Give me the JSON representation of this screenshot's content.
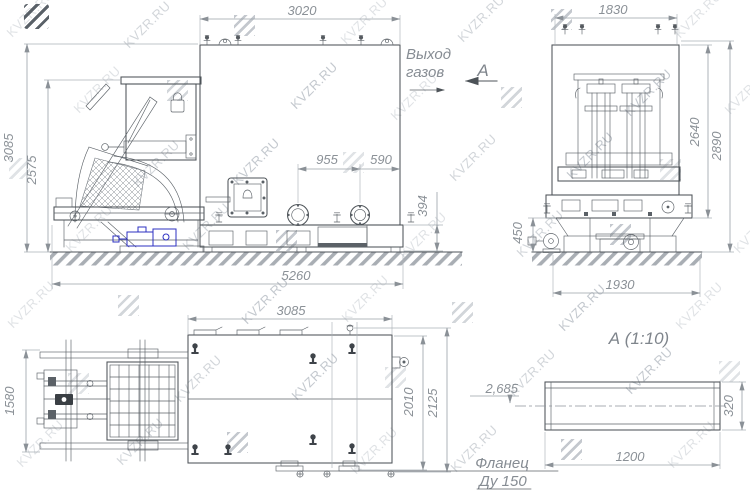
{
  "branding": {
    "watermark_text": "KVZR.RU"
  },
  "front_view": {
    "gas_outlet_line1": "Выход",
    "gas_outlet_line2": "газов",
    "view_arrow_label": "А",
    "dim_width_top": "3020",
    "dim_height_overall": "3085",
    "dim_height_hopper": "2575",
    "dim_flange_spacing": "955",
    "dim_flange_to_edge": "590",
    "dim_base_height": "394",
    "dim_length_overall": "5260"
  },
  "side_view": {
    "dim_width_top": "1830",
    "dim_height_body": "2640",
    "dim_height_overall": "2890",
    "dim_base_height": "450",
    "dim_width_base": "1930"
  },
  "plan_view": {
    "dim_length": "3085",
    "dim_tipper_width": "1580",
    "dim_body_width": "2010",
    "dim_overall_width": "2125"
  },
  "detail_a": {
    "title": "А (1:10)",
    "dim_length": "1200",
    "dim_height": "320",
    "elevation_mark": "2,685",
    "flange_note_line1": "Фланец",
    "flange_note_line2": "Ду 150"
  }
}
